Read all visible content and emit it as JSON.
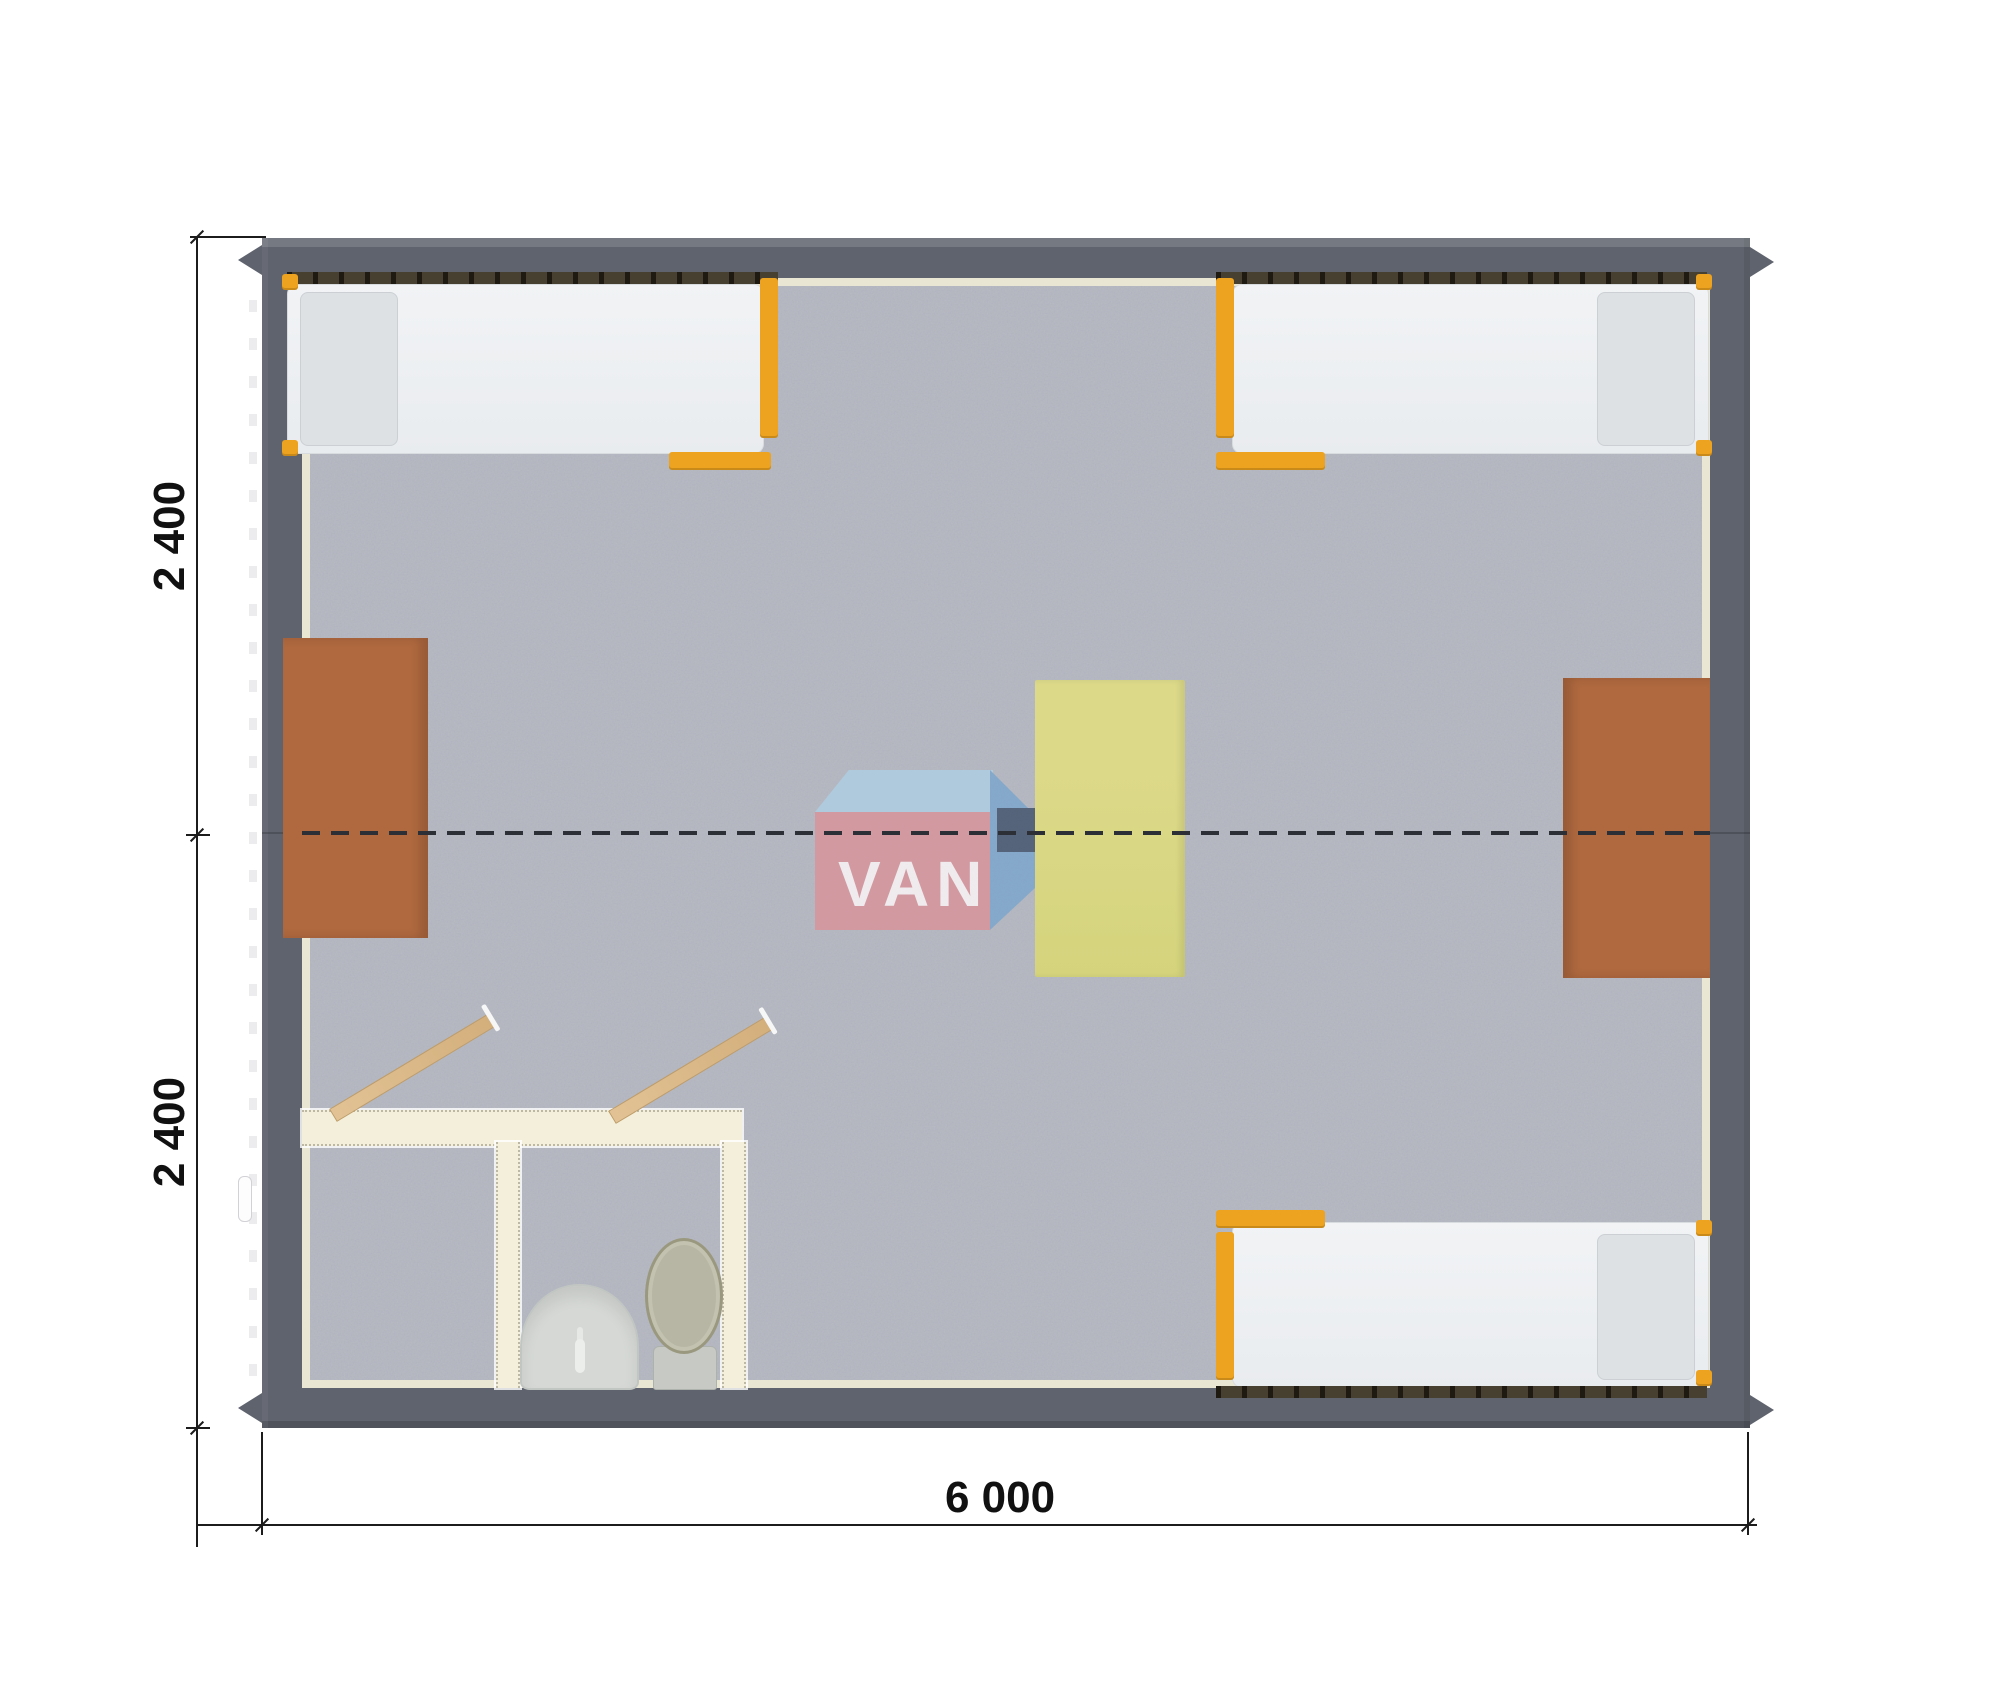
{
  "page": {
    "type_label": "modular-cabin-floor-plan",
    "background": "#ffffff"
  },
  "dimensions": {
    "left_top": "2 400",
    "left_bottom": "2 400",
    "bottom_width": "6 000"
  },
  "watermark": {
    "van": "VAN",
    "da": "DA"
  },
  "colors": {
    "wall": "#5f636d",
    "wall_lining": "#eae6d4",
    "floor": "#b8bbc4",
    "bed_mattress": "#eef0f3",
    "bed_pillow": "#dde1e4",
    "bed_frame_orange": "#eda31f",
    "bed_rail_dark": "#473f30",
    "desk_brown": "#b0693f",
    "table_yellow": "#d7d57f",
    "bathroom_wall_cream": "#f3efdb",
    "door_wood": "#dcb98a",
    "sink_gray": "#d5d8d5",
    "toilet_lid_olive": "#b7b6a4",
    "dimension_line": "#1c1c1c",
    "module_joint_dash": "#2c2f35",
    "logo_pink": "#d9939b",
    "logo_blue_light": "#aecfe3",
    "logo_blue_mid": "#7ba6cd",
    "logo_navy": "#41526b",
    "logo_green": "#92af86",
    "logo_text_white": "#ffffff",
    "logo_text_pale": "#e9e6ad"
  }
}
